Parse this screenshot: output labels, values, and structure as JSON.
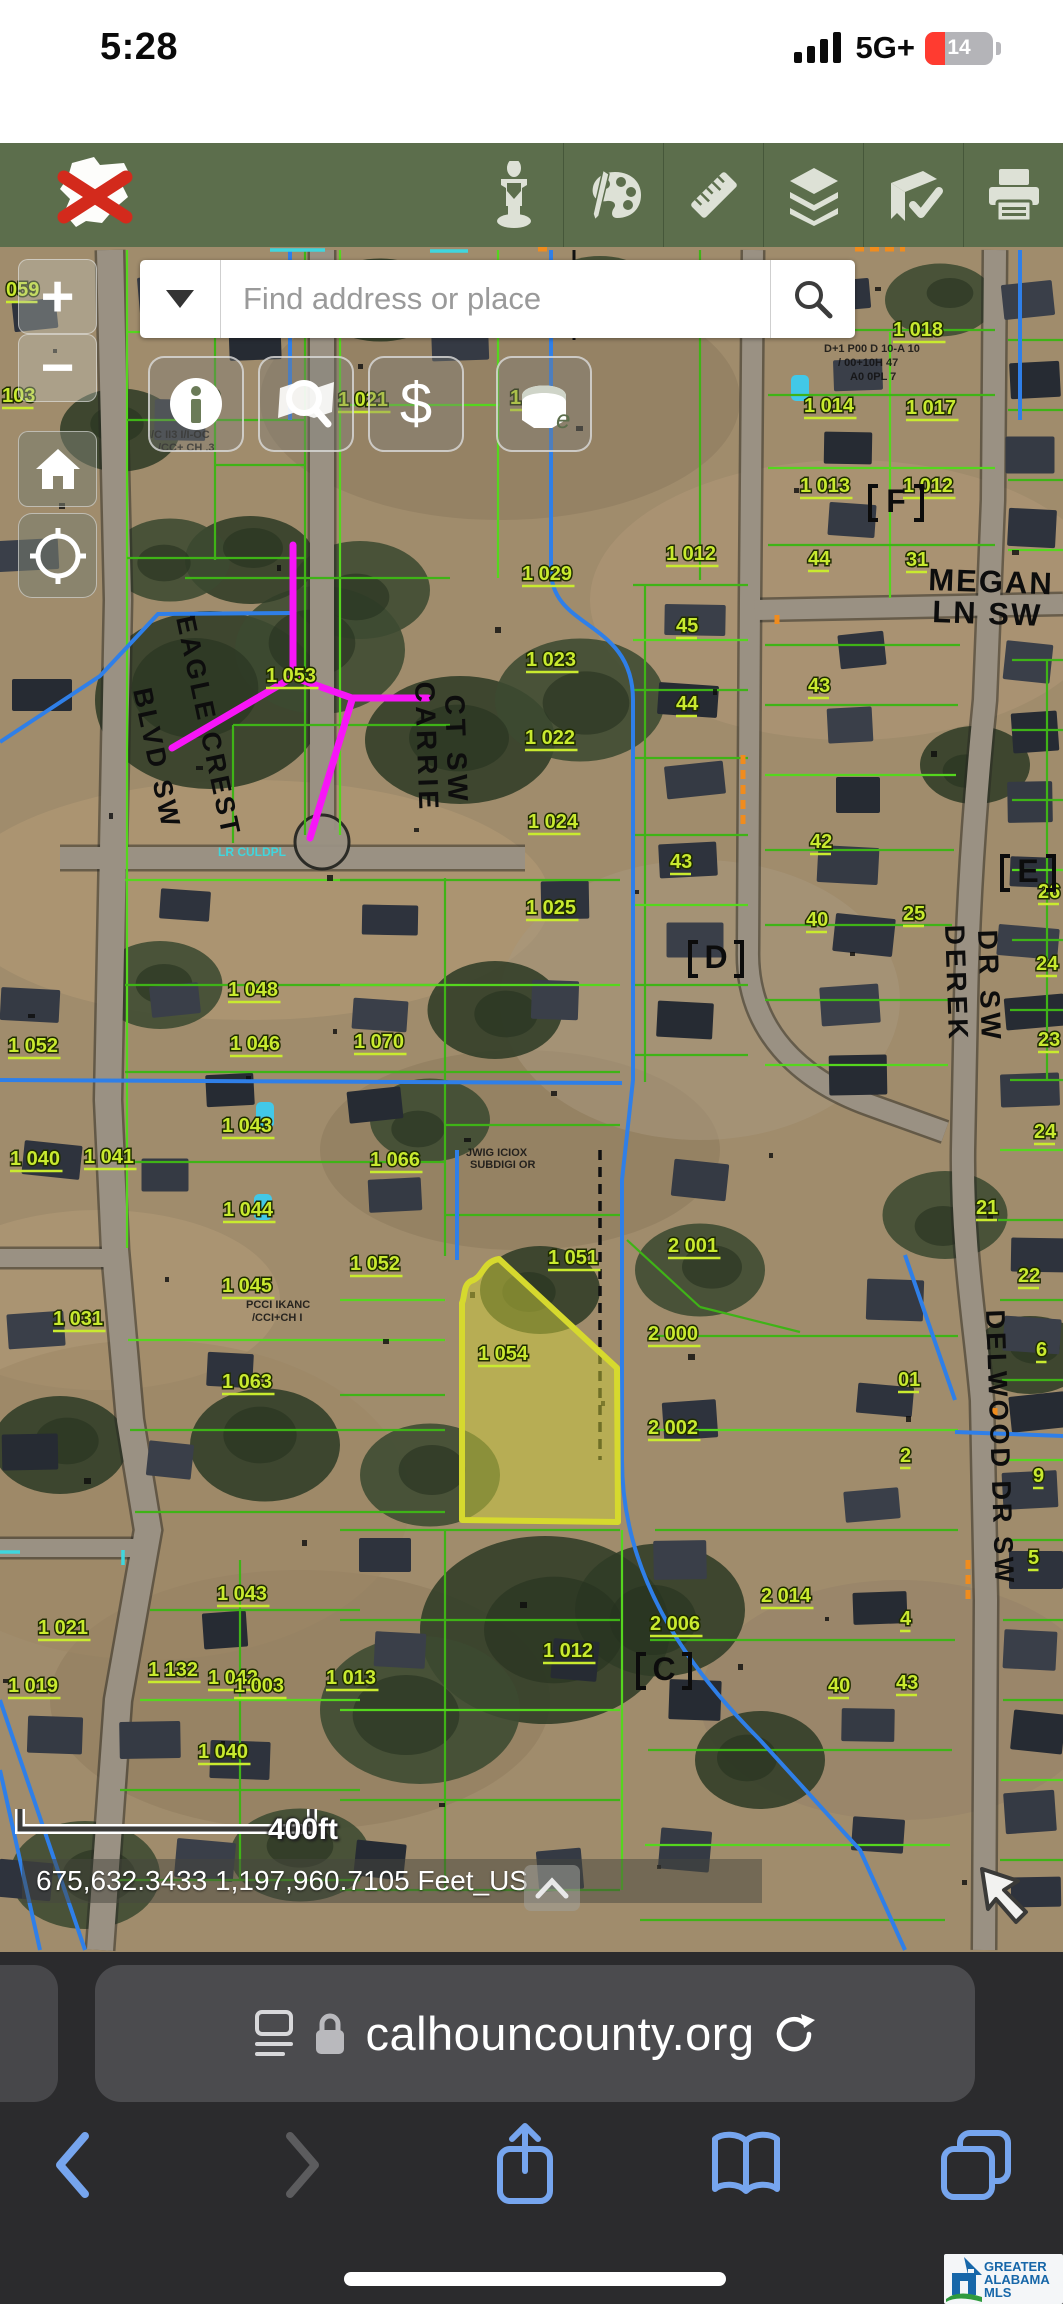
{
  "colors": {
    "toolbar_green": "#5c6e4c",
    "parcel_green": "#3fb317",
    "label_green": "#c9ea2f",
    "annotation_magenta": "#f715f7",
    "highlight_yellow": "#d6d92e",
    "water_blue": "#2f7fe8",
    "safari_blue": "#6fa2ef",
    "battery_red": "#ff3b30"
  },
  "status_bar": {
    "time": "5:28",
    "network": "5G+",
    "battery_percent": "14"
  },
  "gis_toolbar": {
    "icons": [
      "county-logo-close",
      "measure-person",
      "draw-palette",
      "ruler",
      "layers",
      "bookmark-check",
      "print"
    ]
  },
  "search": {
    "placeholder": "Find address or place"
  },
  "map_controls": {
    "zoom_in": "+",
    "zoom_out": "−"
  },
  "map": {
    "scale_label": "400ft",
    "coordinates": "675,632.3433 1,197,960.7105 Feet_US",
    "streets": [
      {
        "t": "EAGLE CREST",
        "x": 176,
        "y": 618,
        "rot": 78,
        "fs": 27,
        "ls": 3
      },
      {
        "t": "BLVD SW",
        "x": 133,
        "y": 690,
        "rot": 78,
        "fs": 27,
        "ls": 3
      },
      {
        "t": "CARRIE",
        "x": 415,
        "y": 682,
        "rot": 88,
        "fs": 28,
        "ls": 4
      },
      {
        "t": "CT SW",
        "x": 445,
        "y": 695,
        "rot": 88,
        "fs": 28,
        "ls": 4
      },
      {
        "t": "MEGAN",
        "x": 928,
        "y": 590,
        "rot": 2,
        "fs": 31,
        "ls": 2
      },
      {
        "t": "LN SW",
        "x": 932,
        "y": 622,
        "rot": 2,
        "fs": 31,
        "ls": 2
      },
      {
        "t": "DEREK",
        "x": 945,
        "y": 925,
        "rot": 88,
        "fs": 28,
        "ls": 4
      },
      {
        "t": "DR SW",
        "x": 978,
        "y": 930,
        "rot": 88,
        "fs": 28,
        "ls": 4
      },
      {
        "t": "DELWOOD DR SW",
        "x": 986,
        "y": 1310,
        "rot": 88,
        "fs": 27,
        "ls": 3
      }
    ],
    "parcel_labels": [
      {
        "t": "059",
        "x": 6,
        "y": 296
      },
      {
        "t": "103",
        "x": 2,
        "y": 402
      },
      {
        "t": "70",
        "x": 198,
        "y": 404
      },
      {
        "t": "1 021",
        "x": 338,
        "y": 406
      },
      {
        "t": "1 019",
        "x": 510,
        "y": 404
      },
      {
        "t": "1 053",
        "x": 266,
        "y": 682
      },
      {
        "t": "1 029",
        "x": 522,
        "y": 580
      },
      {
        "t": "1 023",
        "x": 526,
        "y": 666
      },
      {
        "t": "1 022",
        "x": 525,
        "y": 744
      },
      {
        "t": "1 024",
        "x": 528,
        "y": 828
      },
      {
        "t": "1 025",
        "x": 526,
        "y": 914
      },
      {
        "t": "1 012",
        "x": 666,
        "y": 560
      },
      {
        "t": "45",
        "x": 676,
        "y": 632
      },
      {
        "t": "44",
        "x": 676,
        "y": 710
      },
      {
        "t": "43",
        "x": 670,
        "y": 868
      },
      {
        "t": "44",
        "x": 808,
        "y": 565
      },
      {
        "t": "43",
        "x": 808,
        "y": 692
      },
      {
        "t": "42",
        "x": 810,
        "y": 848
      },
      {
        "t": "40",
        "x": 806,
        "y": 926
      },
      {
        "t": "1 018",
        "x": 893,
        "y": 336
      },
      {
        "t": "1 014",
        "x": 804,
        "y": 412
      },
      {
        "t": "1 017",
        "x": 906,
        "y": 414
      },
      {
        "t": "1 013",
        "x": 800,
        "y": 492
      },
      {
        "t": "1 012",
        "x": 903,
        "y": 492
      },
      {
        "t": "31",
        "x": 906,
        "y": 566
      },
      {
        "t": "1 052",
        "x": 8,
        "y": 1052
      },
      {
        "t": "1 048",
        "x": 228,
        "y": 996
      },
      {
        "t": "1 046",
        "x": 230,
        "y": 1050
      },
      {
        "t": "1 070",
        "x": 354,
        "y": 1048
      },
      {
        "t": "1 040",
        "x": 10,
        "y": 1165
      },
      {
        "t": "1 041",
        "x": 84,
        "y": 1163
      },
      {
        "t": "1 043",
        "x": 222,
        "y": 1132
      },
      {
        "t": "1 044",
        "x": 223,
        "y": 1216
      },
      {
        "t": "1 066",
        "x": 370,
        "y": 1166
      },
      {
        "t": "1 052",
        "x": 350,
        "y": 1270
      },
      {
        "t": "1 031",
        "x": 53,
        "y": 1325
      },
      {
        "t": "1 045",
        "x": 222,
        "y": 1292
      },
      {
        "t": "1 063",
        "x": 222,
        "y": 1388
      },
      {
        "t": "1 051",
        "x": 548,
        "y": 1264
      },
      {
        "t": "1 054",
        "x": 478,
        "y": 1360
      },
      {
        "t": "2 001",
        "x": 668,
        "y": 1252
      },
      {
        "t": "2 000",
        "x": 648,
        "y": 1340
      },
      {
        "t": "2 002",
        "x": 648,
        "y": 1434
      },
      {
        "t": "2 006",
        "x": 650,
        "y": 1630
      },
      {
        "t": "25",
        "x": 903,
        "y": 920
      },
      {
        "t": "26",
        "x": 1038,
        "y": 898
      },
      {
        "t": "24",
        "x": 1036,
        "y": 970
      },
      {
        "t": "23",
        "x": 1038,
        "y": 1046
      },
      {
        "t": "24",
        "x": 1034,
        "y": 1138
      },
      {
        "t": "21",
        "x": 976,
        "y": 1214
      },
      {
        "t": "22",
        "x": 1018,
        "y": 1282
      },
      {
        "t": "6",
        "x": 1036,
        "y": 1356
      },
      {
        "t": "01",
        "x": 898,
        "y": 1386
      },
      {
        "t": "2",
        "x": 900,
        "y": 1462
      },
      {
        "t": "9",
        "x": 1033,
        "y": 1482
      },
      {
        "t": "5",
        "x": 1028,
        "y": 1564
      },
      {
        "t": "4",
        "x": 900,
        "y": 1625
      },
      {
        "t": "1 021",
        "x": 38,
        "y": 1634
      },
      {
        "t": "1 043",
        "x": 217,
        "y": 1600
      },
      {
        "t": "1 042",
        "x": 208,
        "y": 1684
      },
      {
        "t": "1 040",
        "x": 198,
        "y": 1758
      },
      {
        "t": "1 019",
        "x": 8,
        "y": 1692
      },
      {
        "t": "1 132",
        "x": 148,
        "y": 1676
      },
      {
        "t": "1 003",
        "x": 234,
        "y": 1692
      },
      {
        "t": "1 013",
        "x": 326,
        "y": 1684
      },
      {
        "t": "1 012",
        "x": 543,
        "y": 1657
      },
      {
        "t": "2 014",
        "x": 761,
        "y": 1602
      },
      {
        "t": "40",
        "x": 828,
        "y": 1692
      },
      {
        "t": "43",
        "x": 896,
        "y": 1689
      }
    ],
    "block_letters": [
      {
        "t": "F",
        "x": 890,
        "y": 512
      },
      {
        "t": "E",
        "x": 1022,
        "y": 882
      },
      {
        "t": "D",
        "x": 710,
        "y": 968
      },
      {
        "t": "C",
        "x": 658,
        "y": 1680
      }
    ],
    "small_texts": [
      {
        "t": "I/C II3 I/I-OC",
        "x": 148,
        "y": 438
      },
      {
        "t": "/CC+ CH .3",
        "x": 158,
        "y": 451
      },
      {
        "t": "D+1 P00 D 10-A 10",
        "x": 824,
        "y": 352
      },
      {
        "t": "/ 00+10H 47",
        "x": 838,
        "y": 366
      },
      {
        "t": "A0 0PL 7",
        "x": 850,
        "y": 380
      },
      {
        "t": "JWIG ICIOX",
        "x": 466,
        "y": 1156
      },
      {
        "t": "SUBDIGI OR",
        "x": 470,
        "y": 1168
      },
      {
        "t": "PCCI IKANC",
        "x": 246,
        "y": 1308
      },
      {
        "t": "/CCI+CH I",
        "x": 252,
        "y": 1321
      }
    ],
    "culdesac_label": {
      "t": "LR CULDPL",
      "x": 218,
      "y": 612
    }
  },
  "browser": {
    "url": "calhouncounty.org"
  },
  "mls_logo": {
    "line1": "GREATER",
    "line2": "ALABAMA",
    "line3": "MLS"
  }
}
